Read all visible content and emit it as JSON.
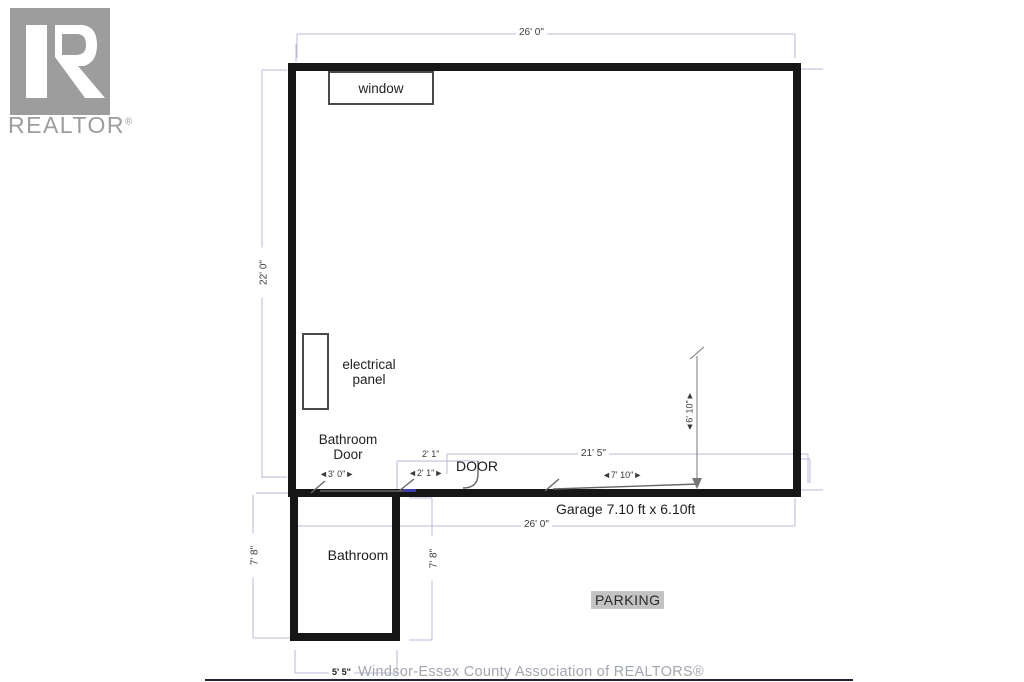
{
  "logo": {
    "letter": "R",
    "wordmark": "REALTOR",
    "registered": "®"
  },
  "floorplan": {
    "rooms": {
      "garage_label": "Garage 7.10 ft x 6.10ft",
      "bathroom_label": "Bathroom",
      "parking_label": "PARKING"
    },
    "features": {
      "window": "window",
      "electrical_panel_line1": "electrical",
      "electrical_panel_line2": "panel",
      "bathroom_door_line1": "Bathroom",
      "bathroom_door_line2": "Door",
      "door": "DOOR"
    },
    "dimensions": {
      "top_width": "26' 0\"",
      "left_height": "22' 0\"",
      "bathroom_door_width": "◄3' 0\"►",
      "entry_door_width_top": "2' 1\"",
      "entry_door_width": "◄2' 1\"►",
      "garage_interior_width": "21' 5\"",
      "garage_door_width": "◄7' 10\"►",
      "garage_door_height": "◄6' 10\"►",
      "bottom_width": "26' 0\"",
      "bathroom_height_left": "7' 8\"",
      "bathroom_height_right": "7' 8\"",
      "bathroom_width": "5' 5\""
    },
    "colors": {
      "wall": "#161616",
      "dimension_line": "#b9badb",
      "door_symbol": "#666666",
      "wall_opening_mark": "#3c3cae",
      "parking_bg": "#c3c3c3",
      "logo_gray": "#9d9d9d",
      "watermark_text": "#a2a6b0"
    }
  },
  "footer": {
    "watermark": "Windsor-Essex County Association of REALTORS®"
  }
}
